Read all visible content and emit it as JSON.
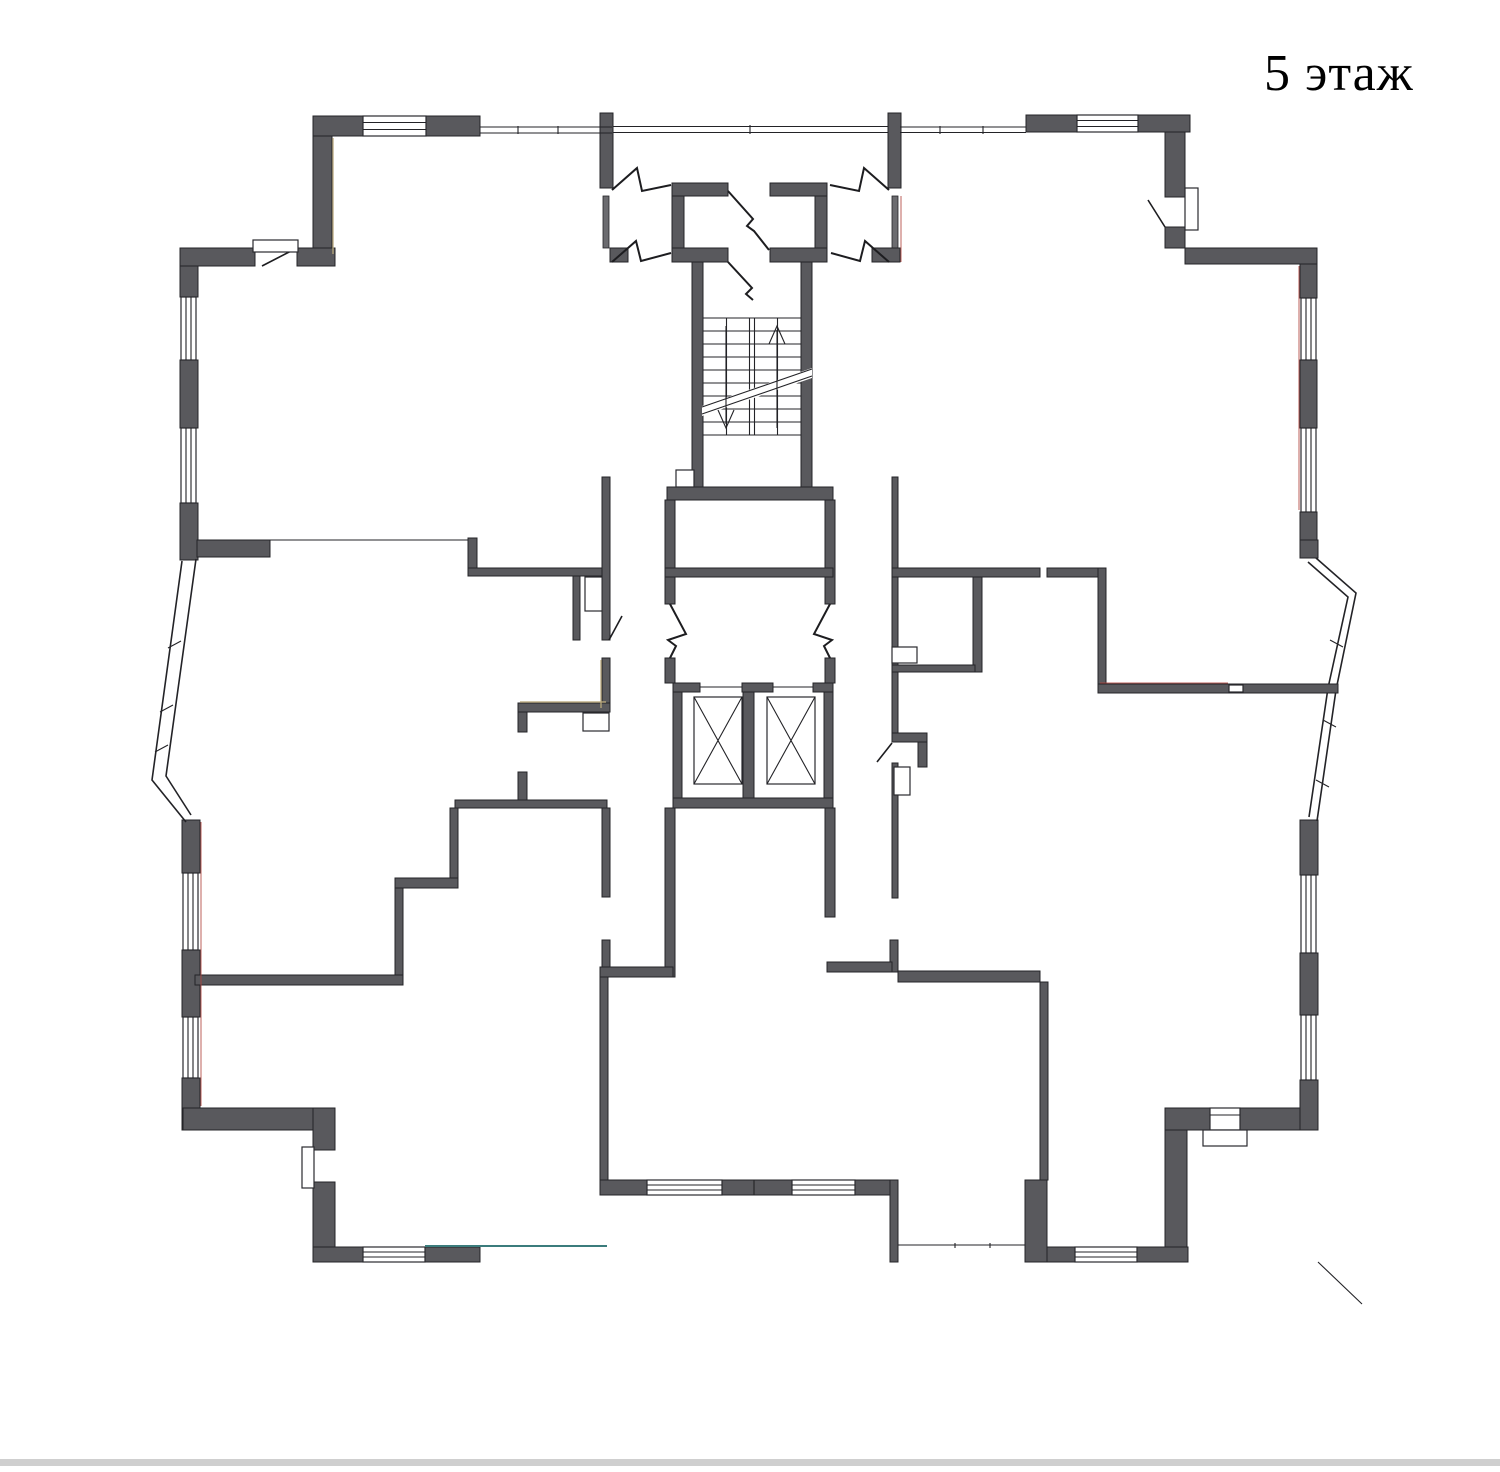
{
  "title": "5 этаж",
  "plan": {
    "floor_number": "5",
    "floor_word": "этаж",
    "type": "residential-floor-plan"
  },
  "colors": {
    "background": "#ffffff",
    "wall": "#59595d",
    "wall_outline": "#242428",
    "thin_line": "#232327",
    "terrace_edge_teal": "#3b7c7c",
    "hairline_red": "#b0453e",
    "hairline_tan": "#b9a87c"
  },
  "features": {
    "staircase": "double-flight stair with up and down arrows and break line",
    "elevators": "two elevator shafts marked with X",
    "vestibule_doors": "zigzag smoke-door symbols at entrance vestibule",
    "windows": "double-line glazing in outer walls",
    "bay_windows": "angled glazed bays on left and right facades",
    "vents": "small white shaft boxes along walls"
  }
}
